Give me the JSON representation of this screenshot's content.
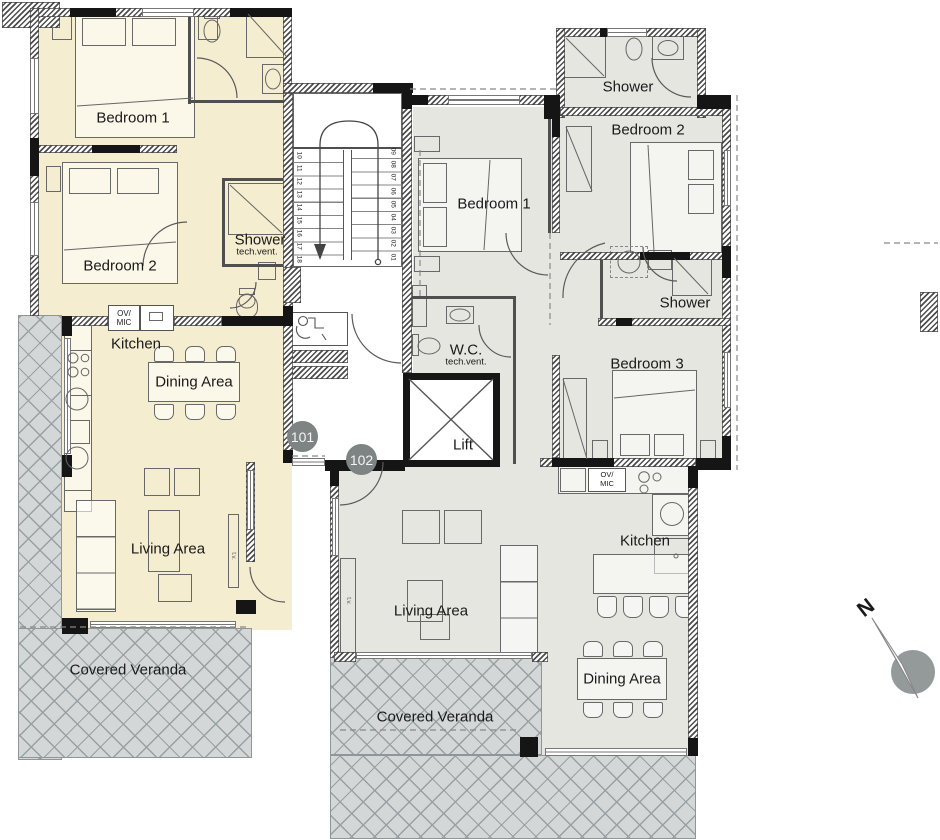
{
  "apt101": {
    "unit": "101",
    "rooms": {
      "bedroom1": "Bedroom 1",
      "bedroom2": "Bedroom 2",
      "shower": "Shower",
      "shower_vent": "tech.vent.",
      "kitchen": "Kitchen",
      "dining": "Dining Area",
      "living": "Living Area",
      "veranda": "Covered Veranda"
    },
    "appliances": {
      "ov": "OV/",
      "mic": "MIC"
    }
  },
  "apt102": {
    "unit": "102",
    "rooms": {
      "bedroom1": "Bedroom 1",
      "bedroom2": "Bedroom 2",
      "bedroom3": "Bedroom 3",
      "shower_top": "Shower",
      "shower_mid": "Shower",
      "wc": "W.C.",
      "wc_vent": "tech.vent.",
      "kitchen": "Kitchen",
      "dining": "Dining Area",
      "living": "Living Area",
      "veranda": "Covered Veranda"
    },
    "appliances": {
      "ov": "OV/",
      "mic": "MIC"
    }
  },
  "core": {
    "lift": "Lift",
    "stairs_left": [
      "10",
      "11",
      "12",
      "13",
      "14",
      "15",
      "16",
      "17",
      "18"
    ],
    "stairs_right": [
      "09",
      "08",
      "07",
      "06",
      "05",
      "04",
      "03",
      "02",
      "01"
    ]
  },
  "compass": {
    "north": "N"
  },
  "misc": {
    "tv": "t.v."
  },
  "colors": {
    "apt101_fill": "#f5edcf",
    "apt102_fill": "#e6e6e1",
    "veranda_fill": "#d4d7d8",
    "wall": "#151515",
    "badge": "#7e8384"
  }
}
